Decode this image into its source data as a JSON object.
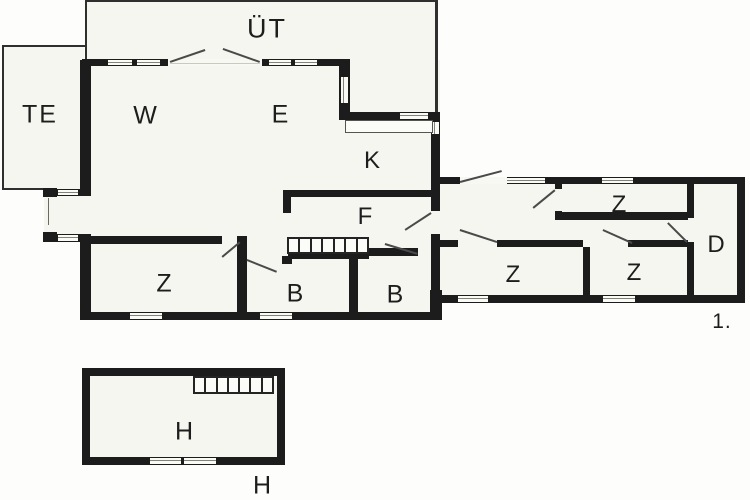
{
  "plan": {
    "rooms": {
      "ut": "ÜT",
      "te": "TE",
      "w": "W",
      "e": "E",
      "k": "K",
      "f": "F",
      "z_left": "Z",
      "b_left": "B",
      "b_right": "B",
      "z_top": "Z",
      "z_mid": "Z",
      "z_right": "Z",
      "d": "D",
      "h": "H"
    },
    "captions": {
      "floor_number": "1.",
      "h_building": "H"
    },
    "colors": {
      "wall": "#1c1c1c",
      "paper": "#f6f6f0",
      "line": "#4a4a4a"
    }
  }
}
